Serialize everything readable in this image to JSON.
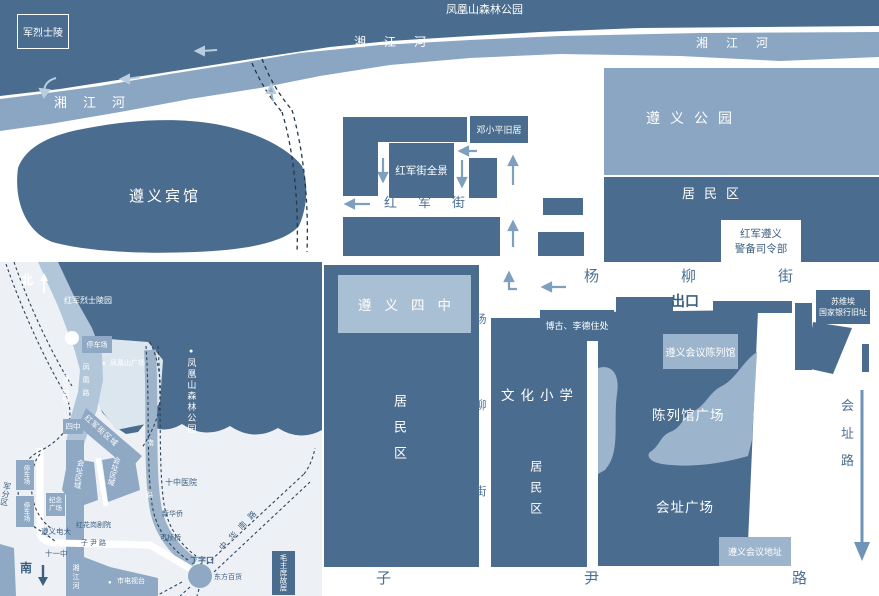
{
  "main": {
    "park_top": "凤凰山森林公园",
    "martyr": "军烈士陵",
    "river": "湘江河",
    "hotel": "遵义宾馆",
    "zunyi_park": "遵义公园",
    "residential": "居民区",
    "garrison1": "红军遵义",
    "garrison2": "警备司令部",
    "deng": "邓小平旧居",
    "pano": "红军街全景",
    "hongjun_st": "红军街",
    "yangliu": "杨柳街",
    "exit": "出口",
    "soviet1": "苏维埃",
    "soviet2": "国家银行旧址",
    "bogu": "博古、李德住处",
    "exhibit_hall": "遵义会议陈列馆",
    "school4": "遵义四中",
    "culture_school": "文化小学",
    "exhibit_plaza": "陈列馆广场",
    "site_plaza": "会址广场",
    "site_addr": "遵义会议地址",
    "huizhi_rd": "会址路",
    "ziyin_rd": "子尹路"
  },
  "inset": {
    "north": "北",
    "south": "南",
    "martyr_park": "红军烈士陵园",
    "parking": "停车场",
    "fh_square": "凤凰山广场",
    "forest_park": "凤凰山森林公园",
    "hotel": "遵义宾馆",
    "fh_road": "凤凰路",
    "school4": "四中",
    "hongjun_area": "红军街区域",
    "site_area": "会址区域",
    "memorial1": "纪念",
    "memorial2": "广场",
    "military": "军分区",
    "tv_univ": "遵义电大",
    "theater": "红花岗剧院",
    "school11": "十一中",
    "ziyin_rd": "子尹路",
    "river": "湘江河",
    "hospital": "十中医院",
    "nan": "南",
    "lu": "路",
    "xinhua": "新华侨",
    "bridge": "可桢桥",
    "dingzikou": "丁字口",
    "dept_store": "东方百货",
    "zhonghua_rd": "中华南路",
    "mao": "毛主席故居",
    "tv_station": "市电视台",
    "dot": "●"
  },
  "colors": {
    "dark": "#4a6c8e",
    "medium": "#8aa6c2",
    "light_box": "#a9bfd4",
    "lighter_box": "#9db5cc",
    "inset_medium": "#8fa9c4",
    "label_blue": "#3c5f82",
    "street": "#4f7094"
  }
}
